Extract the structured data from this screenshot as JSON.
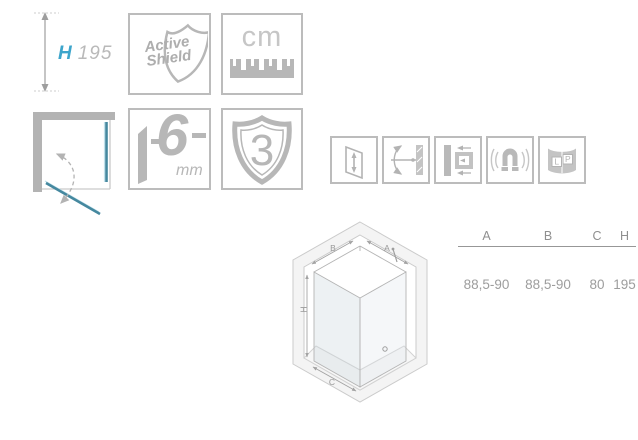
{
  "colors": {
    "accent_blue": "#3da5cb",
    "glass_teal": "#45889f",
    "icon_gray": "#b7b7b7",
    "box_border_gray": "#bcbcbc",
    "wall_gray": "#b3b3b3",
    "table_text_gray": "#8f8f8f"
  },
  "height_dim": {
    "label": "H",
    "value": "195"
  },
  "badges": {
    "active_shield": {
      "line1": "Active",
      "line2": "Shield"
    },
    "unit_badge": {
      "text": "cm"
    },
    "glass_thickness": {
      "value": "6",
      "unit": "mm"
    },
    "warranty": {
      "value": "3"
    }
  },
  "feature_icons": [
    {
      "name": "door-height-adjust"
    },
    {
      "name": "door-double-swing"
    },
    {
      "name": "wall-profile-adjust"
    },
    {
      "name": "magnetic-closure"
    },
    {
      "name": "left-right-universal",
      "left_label": "L",
      "right_label": "P"
    }
  ],
  "iso_diagram": {
    "labels": {
      "b": "B",
      "a": "A",
      "h": "H",
      "c": "C"
    }
  },
  "size_table": {
    "columns": [
      "A",
      "B",
      "C",
      "H"
    ],
    "values": [
      "88,5-90",
      "88,5-90",
      "80",
      "195"
    ]
  }
}
